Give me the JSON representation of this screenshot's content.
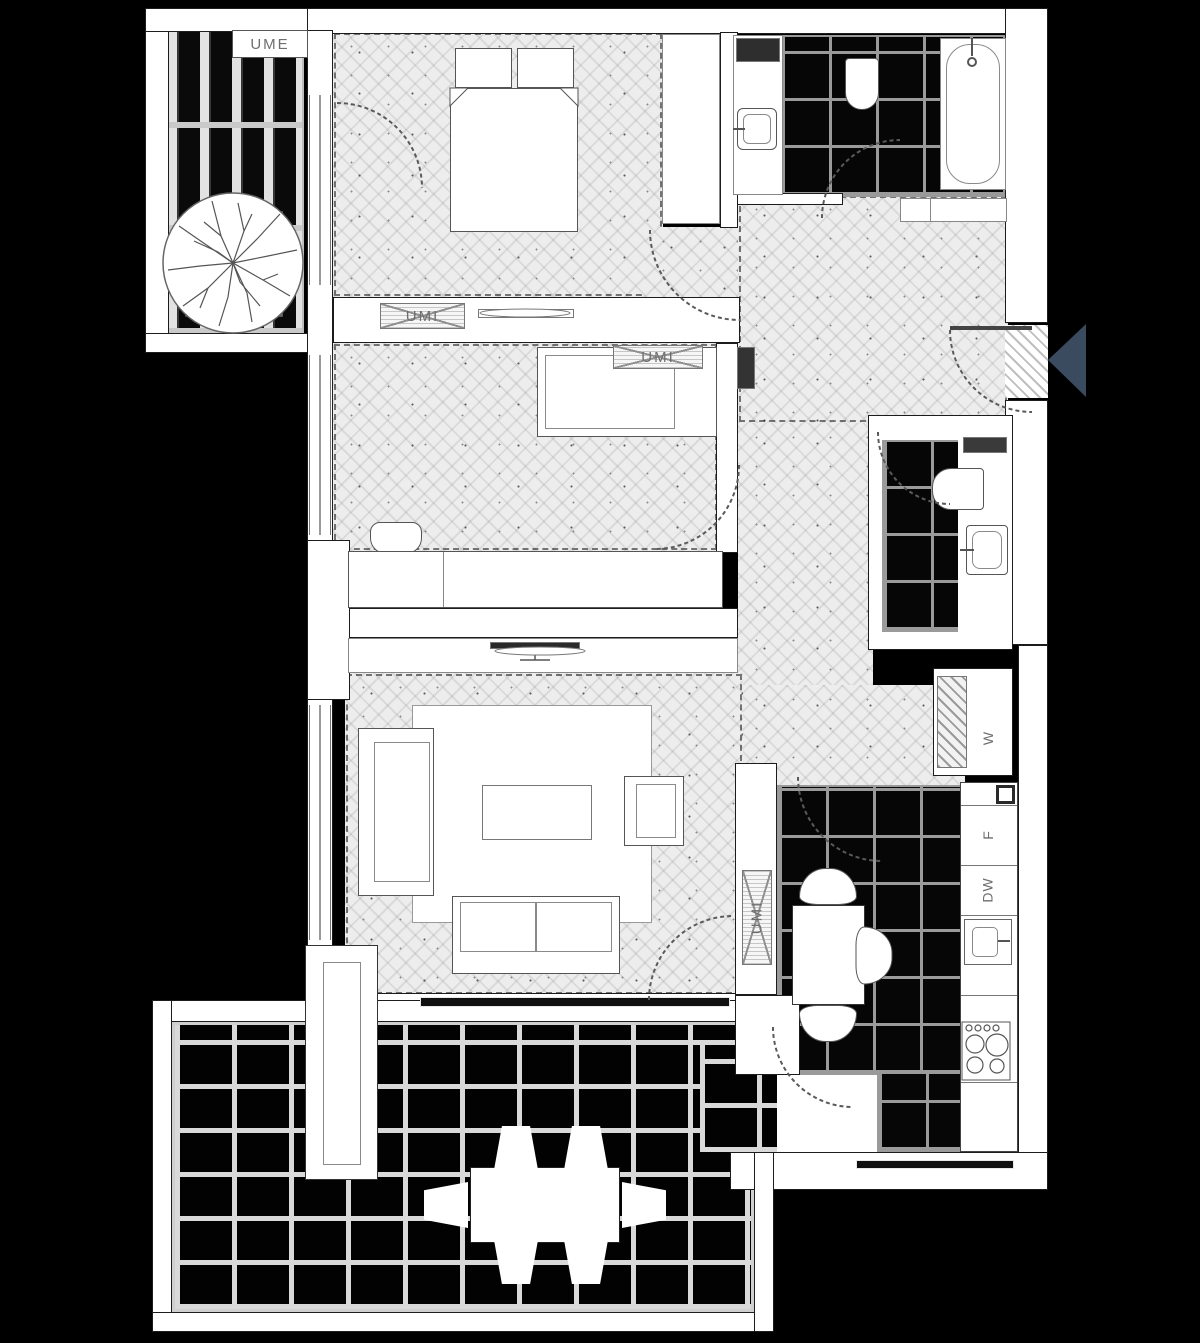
{
  "plan": {
    "type": "apartment-floor-plan",
    "labels": {
      "balcony_cabinet": "UME",
      "bedroom1_cabinet": "UMI",
      "bedroom2_cabinet": "UMI",
      "kitchen_cabinet": "UMI",
      "washer": "W",
      "fridge": "F",
      "dishwasher": "DW"
    },
    "colors": {
      "background": "#000000",
      "wall": "#ffffff",
      "wood_floor": "#ededed",
      "dark_tile": "#060606",
      "tile_grout": "#9a9a9a",
      "terrace_grout": "#d9d9d9",
      "label_text": "#6e6e6e",
      "entrance_arrow": "#3a4a5f"
    }
  }
}
